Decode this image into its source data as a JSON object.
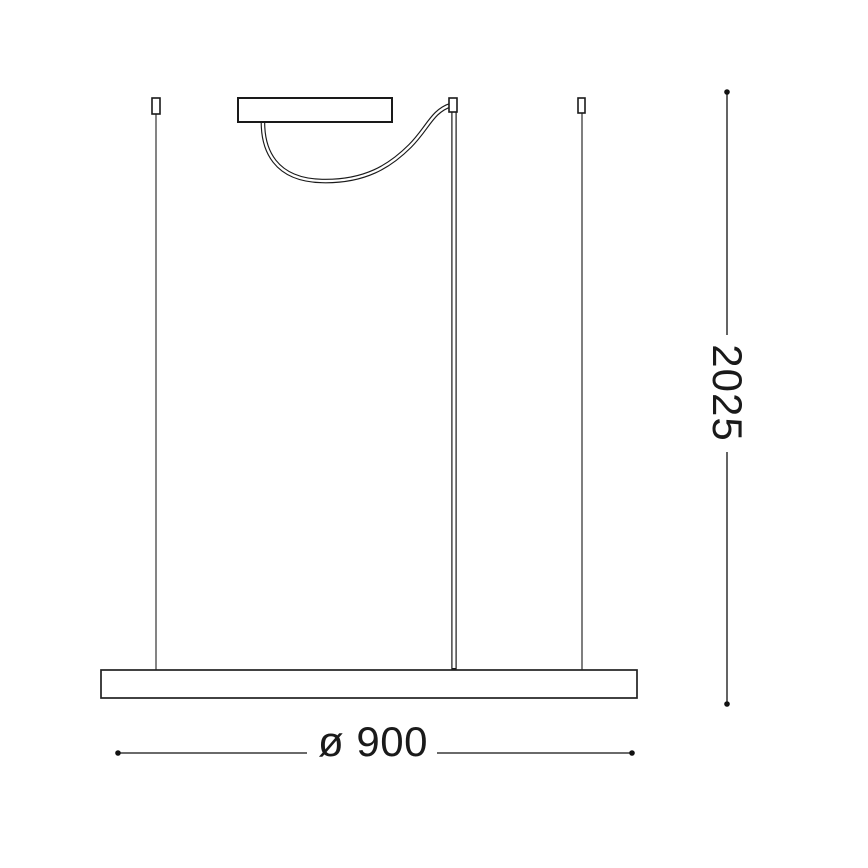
{
  "diagram": {
    "type": "pendant-lamp-dimension-drawing",
    "dimensions": {
      "width_label": "ø 900",
      "height_label": "2025"
    },
    "colors": {
      "line": "#1a1a1a",
      "wire": "#444444",
      "background": "#ffffff"
    }
  }
}
